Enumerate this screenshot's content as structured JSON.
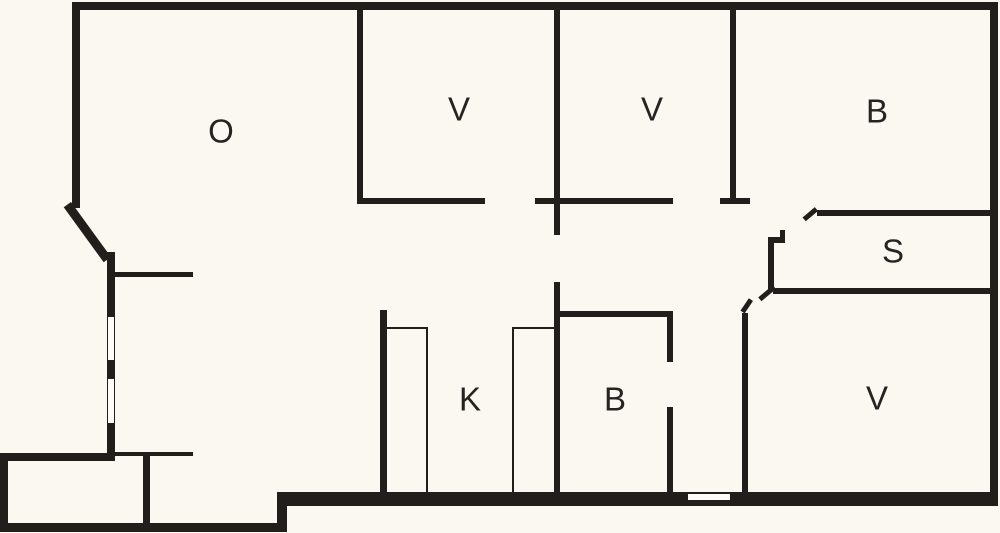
{
  "floor_plan": {
    "background_color": "#faf8f1",
    "wall_color": "#211e1c",
    "window_fill": "#fdfcf8",
    "label_color": "#262422",
    "rooms": [
      {
        "label": "O",
        "x": 221,
        "y": 131
      },
      {
        "label": "V",
        "x": 459,
        "y": 109
      },
      {
        "label": "V",
        "x": 652,
        "y": 109
      },
      {
        "label": "B",
        "x": 877,
        "y": 111
      },
      {
        "label": "S",
        "x": 893,
        "y": 251
      },
      {
        "label": "V",
        "x": 877,
        "y": 398
      },
      {
        "label": "B",
        "x": 615,
        "y": 399
      },
      {
        "label": "K",
        "x": 470,
        "y": 399
      }
    ],
    "walls": [
      {
        "name": "top-exterior-wall",
        "x": 72,
        "y": 2,
        "w": 926,
        "h": 8
      },
      {
        "name": "right-exterior-wall",
        "x": 990,
        "y": 2,
        "w": 8,
        "h": 504
      },
      {
        "name": "bottom-exterior-wall-main",
        "x": 277,
        "y": 492,
        "w": 721,
        "h": 14
      },
      {
        "name": "bottom-step-wall",
        "x": 277,
        "y": 492,
        "w": 10,
        "h": 40
      },
      {
        "name": "extension-bottom-wall",
        "x": 0,
        "y": 523,
        "w": 287,
        "h": 9
      },
      {
        "name": "extension-left-wall",
        "x": 0,
        "y": 453,
        "w": 8,
        "h": 79
      },
      {
        "name": "extension-top-wall",
        "x": 0,
        "y": 453,
        "w": 113,
        "h": 8
      },
      {
        "name": "extension-divider-wall",
        "x": 143,
        "y": 455,
        "w": 7,
        "h": 70
      },
      {
        "name": "left-exterior-wall-upper",
        "x": 72,
        "y": 2,
        "w": 8,
        "h": 206
      },
      {
        "name": "left-exterior-wall-lower",
        "x": 107,
        "y": 252,
        "w": 8,
        "h": 209
      },
      {
        "name": "entry-partition-wall",
        "x": 113,
        "y": 272,
        "w": 80,
        "h": 5
      },
      {
        "name": "entry-partition-wall-lower",
        "x": 113,
        "y": 452,
        "w": 80,
        "h": 4
      },
      {
        "name": "v1-left-wall",
        "x": 357,
        "y": 8,
        "w": 6,
        "h": 196
      },
      {
        "name": "v1-bottom-wall",
        "x": 357,
        "y": 198,
        "w": 128,
        "h": 6
      },
      {
        "name": "center-wall-upper",
        "x": 554,
        "y": 8,
        "w": 6,
        "h": 227
      },
      {
        "name": "v2-bottom-wall",
        "x": 535,
        "y": 198,
        "w": 138,
        "h": 6
      },
      {
        "name": "v2-right-wall",
        "x": 730,
        "y": 8,
        "w": 6,
        "h": 192
      },
      {
        "name": "v2-right-wall-cap",
        "x": 720,
        "y": 198,
        "w": 30,
        "h": 6
      },
      {
        "name": "center-wall-lower",
        "x": 554,
        "y": 282,
        "w": 6,
        "h": 210
      },
      {
        "name": "bath-top-wall",
        "x": 554,
        "y": 311,
        "w": 119,
        "h": 6
      },
      {
        "name": "bath-right-wall-upper",
        "x": 667,
        "y": 311,
        "w": 6,
        "h": 51
      },
      {
        "name": "bath-right-wall-lower",
        "x": 667,
        "y": 407,
        "w": 6,
        "h": 85
      },
      {
        "name": "hall-wall",
        "x": 742,
        "y": 313,
        "w": 6,
        "h": 179
      },
      {
        "name": "s-top-wall",
        "x": 817,
        "y": 210,
        "w": 173,
        "h": 6
      },
      {
        "name": "s-bottom-wall",
        "x": 773,
        "y": 288,
        "w": 217,
        "h": 6
      },
      {
        "name": "s-closet-wall-vertical",
        "x": 768,
        "y": 237,
        "w": 6,
        "h": 53
      },
      {
        "name": "s-closet-wall-arm",
        "x": 768,
        "y": 237,
        "w": 17,
        "h": 6
      },
      {
        "name": "s-closet-wall-nub",
        "x": 780,
        "y": 230,
        "w": 5,
        "h": 13
      },
      {
        "name": "kitchen-left-wall",
        "x": 380,
        "y": 310,
        "w": 7,
        "h": 182
      },
      {
        "name": "counter-left-line",
        "x": 426,
        "y": 327,
        "w": 2,
        "h": 165
      },
      {
        "name": "counter-left-top-line",
        "x": 386,
        "y": 327,
        "w": 42,
        "h": 2
      },
      {
        "name": "counter-right-line",
        "x": 512,
        "y": 327,
        "w": 2,
        "h": 165
      },
      {
        "name": "counter-right-top-line",
        "x": 512,
        "y": 327,
        "w": 43,
        "h": 2
      }
    ],
    "diagonal_walls": [
      {
        "name": "left-corner-diagonal-wall",
        "x": 71,
        "y": 202,
        "len": 68,
        "t": 9,
        "angle": 54
      },
      {
        "name": "door-tick-s-top",
        "x": 818,
        "y": 211,
        "len": 16,
        "t": 5,
        "angle": 140
      },
      {
        "name": "door-tick-s-bottom",
        "x": 776,
        "y": 289,
        "len": 19,
        "t": 5,
        "angle": 140
      },
      {
        "name": "door-tick-hall",
        "x": 753,
        "y": 301,
        "len": 15,
        "t": 5,
        "angle": 124
      }
    ],
    "windows": [
      {
        "name": "window-left-upper",
        "x": 107,
        "y": 316,
        "w": 8,
        "h": 45
      },
      {
        "name": "window-left-lower",
        "x": 107,
        "y": 378,
        "w": 8,
        "h": 46
      },
      {
        "name": "window-bottom",
        "x": 687,
        "y": 493,
        "w": 44,
        "h": 8
      }
    ]
  }
}
